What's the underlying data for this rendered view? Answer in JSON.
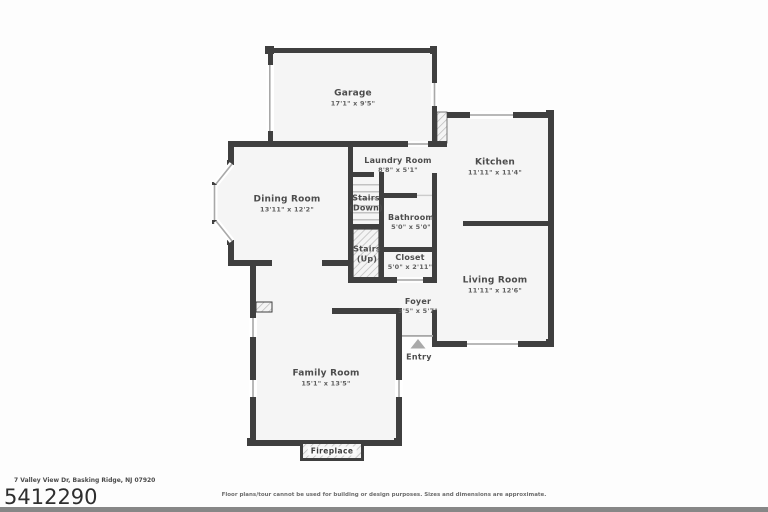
{
  "page": {
    "address": "7 Valley View Dr, Basking Ridge, NJ 07920",
    "listing_number": "5412290",
    "disclaimer": "Floor plans/tour cannot be used for building or design purposes. Sizes and dimensions are approximate."
  },
  "rooms": {
    "garage": {
      "name": "Garage",
      "dims": "17'1\" x 9'5\""
    },
    "laundry": {
      "name": "Laundry Room",
      "dims": "8'8\" x 5'1\""
    },
    "kitchen": {
      "name": "Kitchen",
      "dims": "11'11\" x 11'4\""
    },
    "dining": {
      "name": "Dining Room",
      "dims": "13'11\" x 12'2\""
    },
    "stairs_down": {
      "name": "Stairs",
      "sub": "(Down)"
    },
    "bathroom": {
      "name": "Bathroom",
      "dims": "5'0\" x 5'0\""
    },
    "stairs_up": {
      "name": "Stairs",
      "sub": "(Up)"
    },
    "closet": {
      "name": "Closet",
      "dims": "5'0\" x 2'11\""
    },
    "living": {
      "name": "Living Room",
      "dims": "11'11\" x 12'6\""
    },
    "foyer": {
      "name": "Foyer",
      "dims": "3'5\" x 5'7\""
    },
    "family": {
      "name": "Family Room",
      "dims": "15'1\" x 13'5\""
    },
    "fireplace": {
      "name": "Fireplace"
    },
    "entry": {
      "name": "Entry"
    }
  },
  "colors": {
    "wall": "#3f3f3f",
    "floor": "#f5f5f5",
    "window_line": "#a8a8a8",
    "hatch_stripe": "#b9b9b9",
    "label_text": "#4c4c4c",
    "entry_arrow": "#a9a9a9"
  }
}
